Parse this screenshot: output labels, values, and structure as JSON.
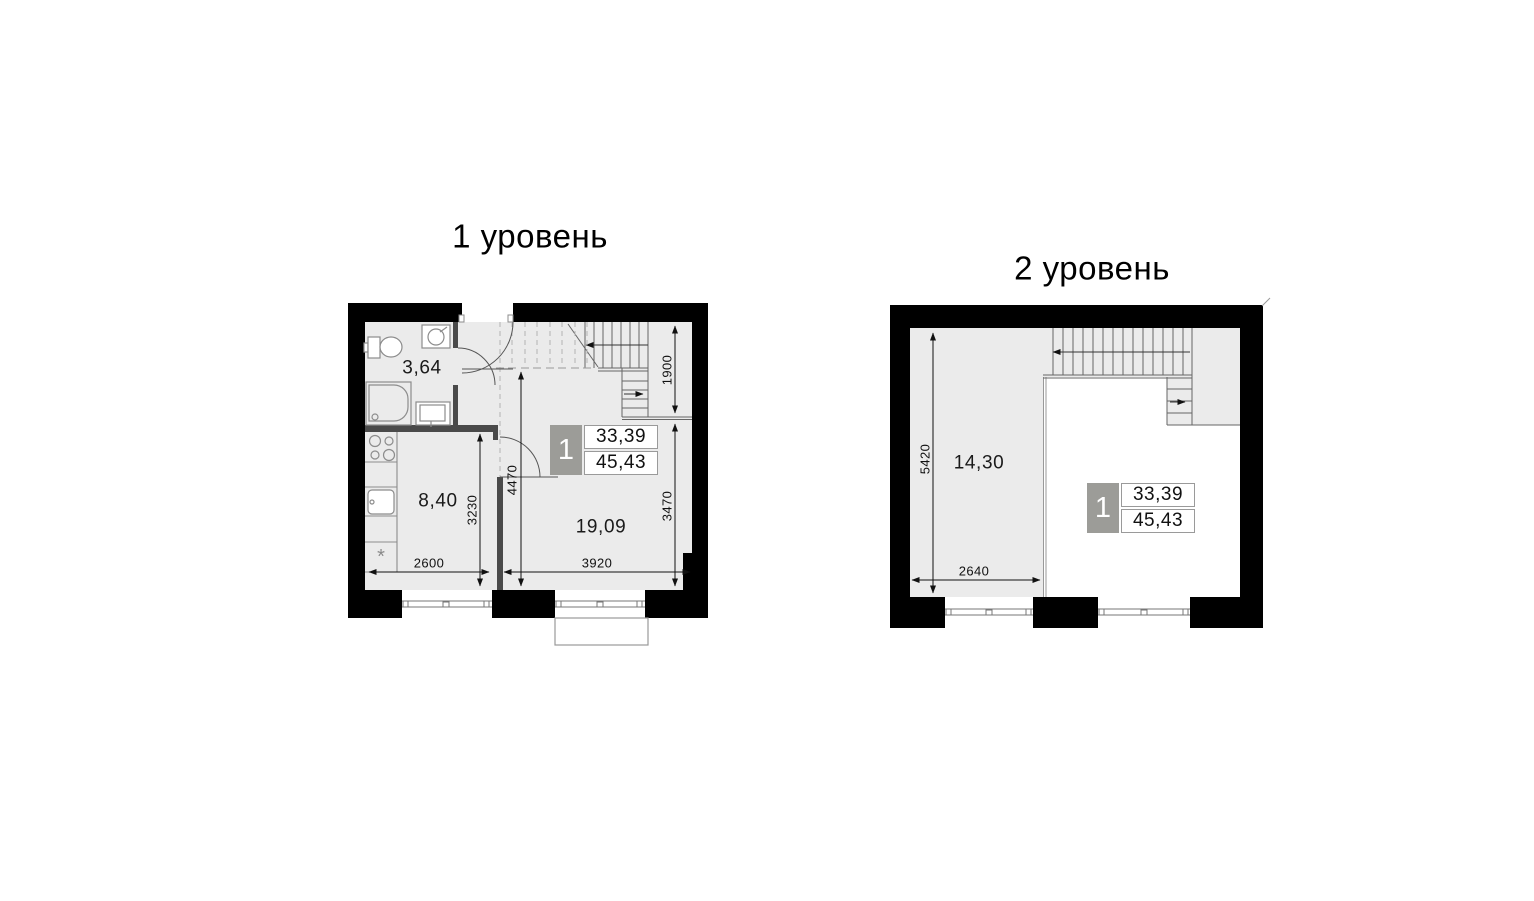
{
  "plans": {
    "level1": {
      "title": "1 уровень",
      "rooms": [
        {
          "name": "bathroom",
          "area": "3,64"
        },
        {
          "name": "kitchen",
          "area": "8,40"
        },
        {
          "name": "living-room",
          "area": "19,09"
        }
      ],
      "dims": {
        "kitchen_width": "2600",
        "living_width": "3920",
        "kitchen_depth": "3230",
        "hall_depth": "4470",
        "living_depth": "3470",
        "stair_depth": "1900"
      },
      "badge": {
        "number": "1",
        "area_living": "33,39",
        "area_total": "45,43"
      },
      "symbols": {
        "fridge": "*"
      }
    },
    "level2": {
      "title": "2 уровень",
      "rooms": [
        {
          "name": "room",
          "area": "14,30"
        }
      ],
      "dims": {
        "room_depth": "5420",
        "room_width": "2640"
      },
      "badge": {
        "number": "1",
        "area_living": "33,39",
        "area_total": "45,43"
      }
    }
  },
  "colors": {
    "wall": "#000000",
    "partition": "#4a4a4a",
    "floor_fill": "#ebebeb",
    "badge_gray": "#9c9c98",
    "line_gray": "#8c8c8c"
  }
}
